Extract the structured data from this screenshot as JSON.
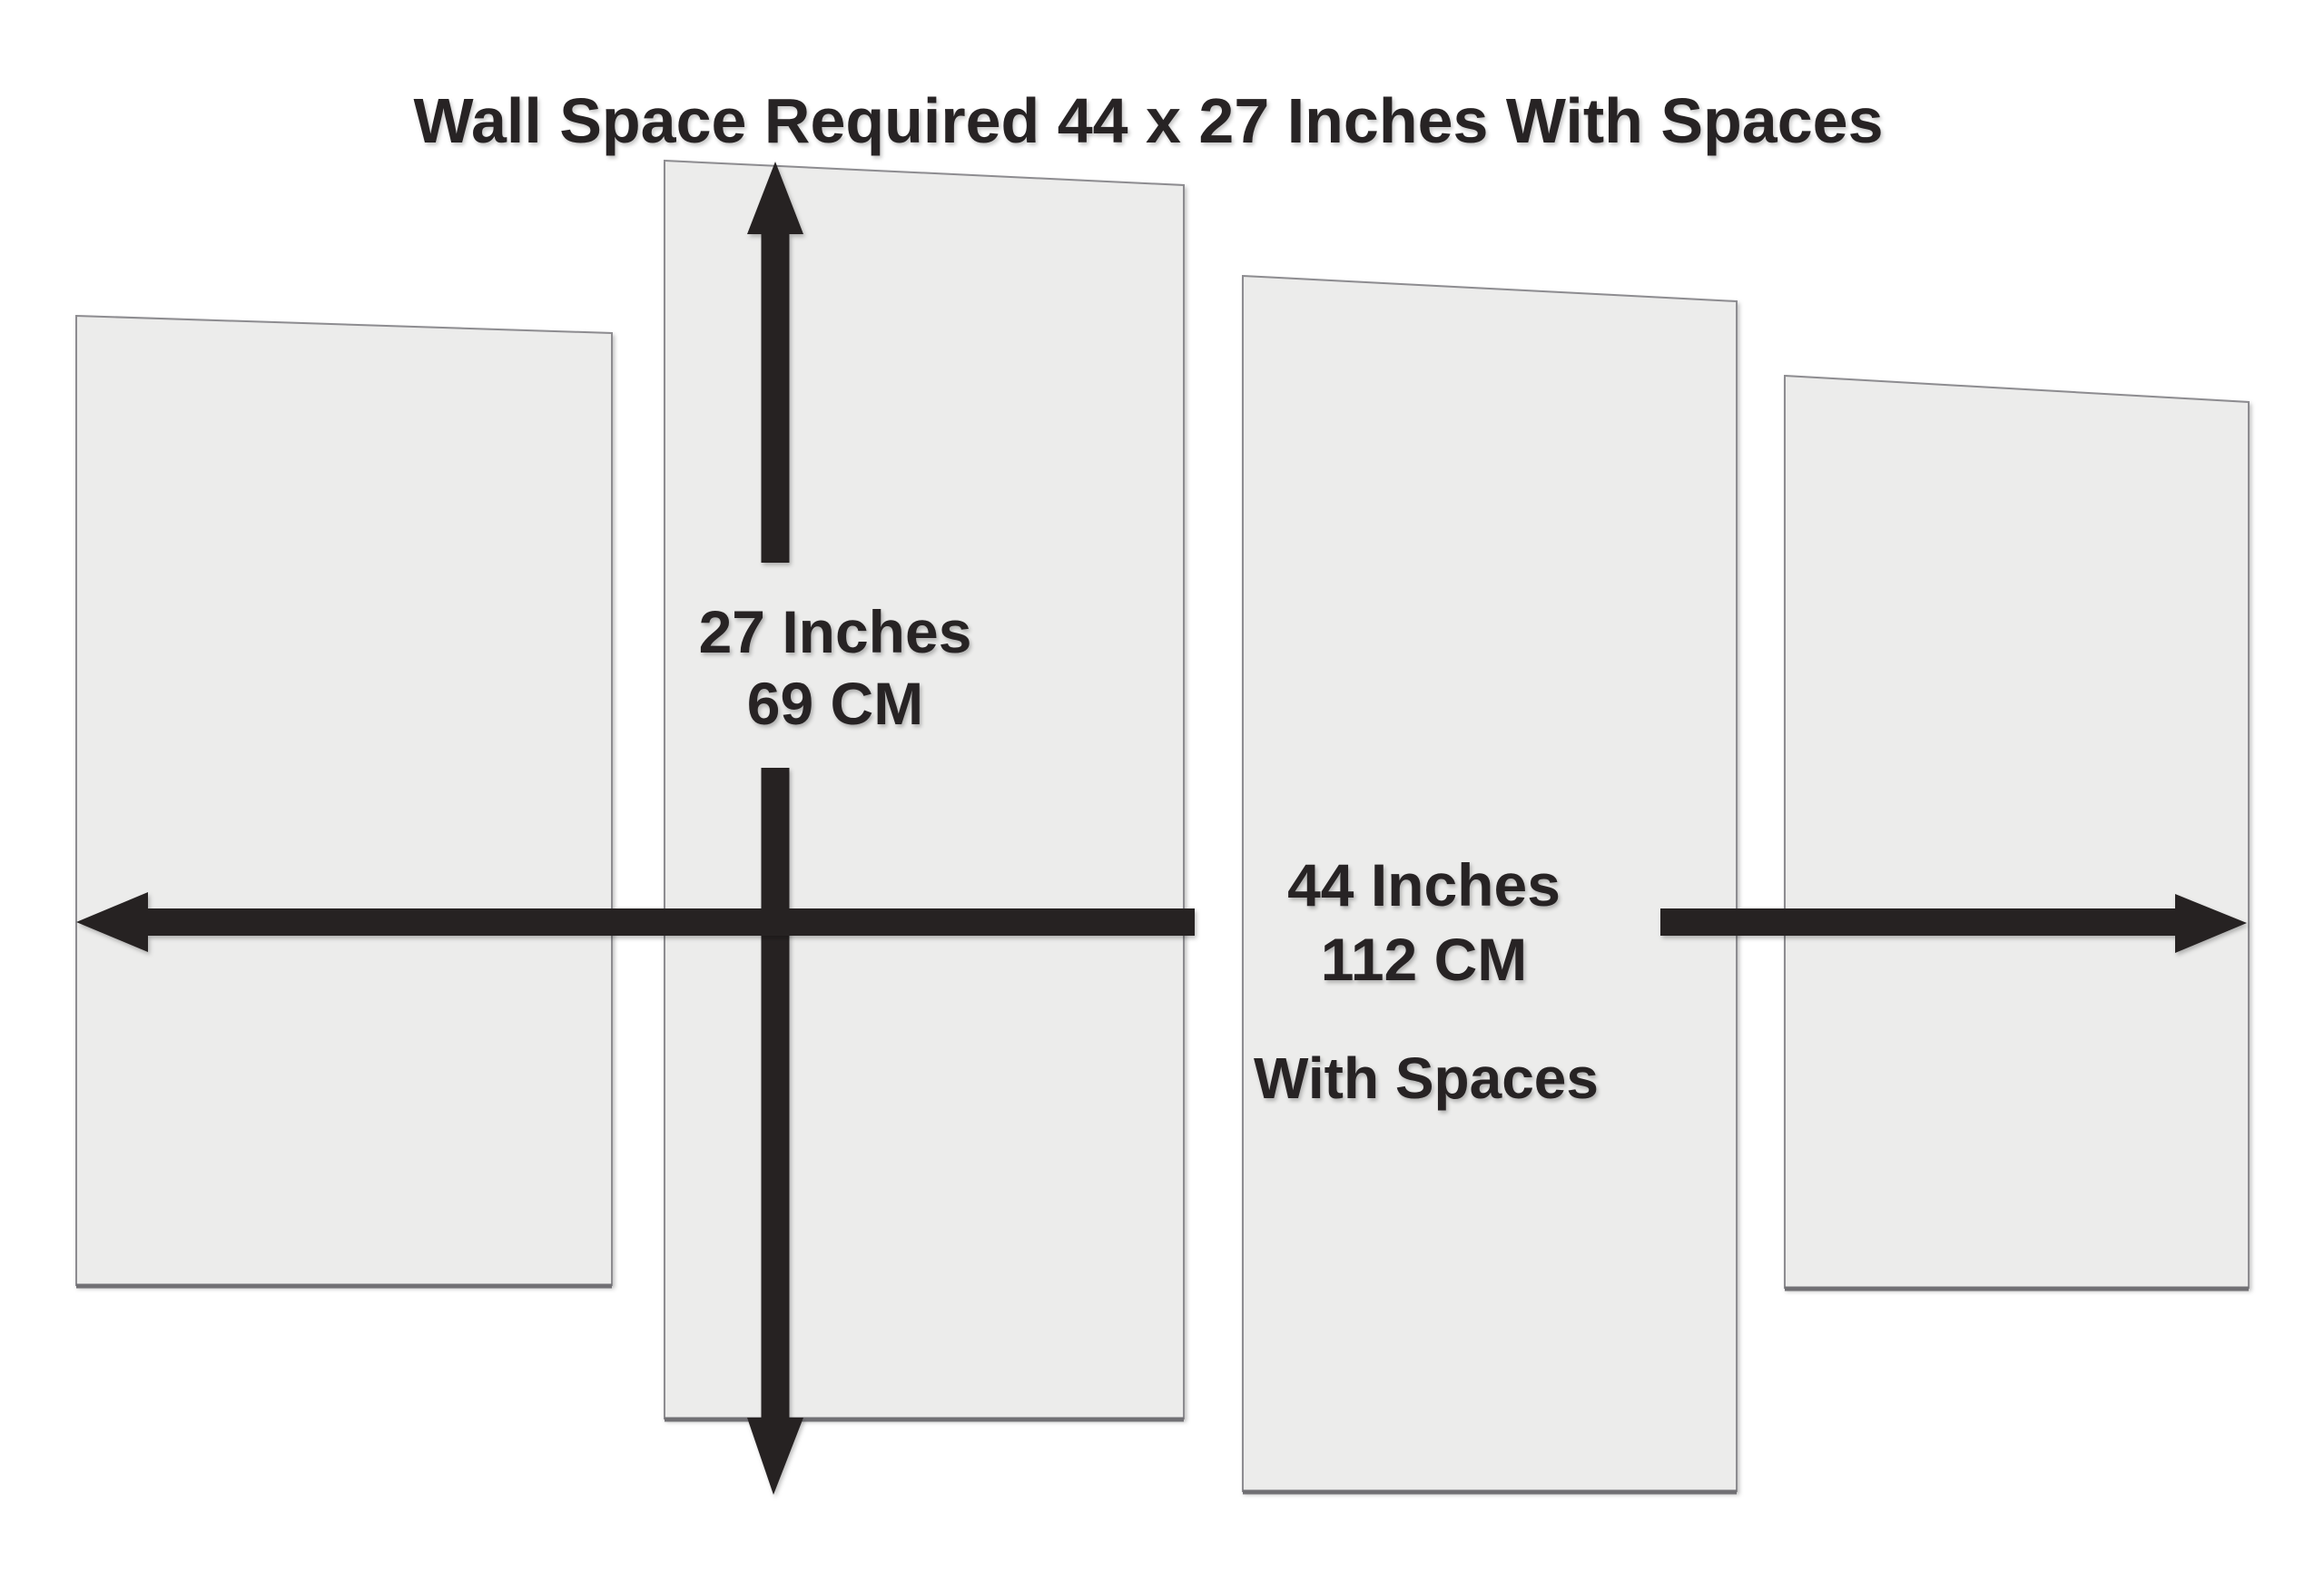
{
  "title": "Wall Space Required 44 x 27 Inches With Spaces",
  "vertical_dimension": {
    "inches": "27 Inches",
    "cm": "69 CM"
  },
  "horizontal_dimension": {
    "inches": "44 Inches",
    "cm": "112 CM",
    "note": "With Spaces"
  },
  "panels": {
    "count": 4
  },
  "theme": {
    "bg": "#ffffff",
    "panelFill": "#ececeb",
    "panelEdge": "#8d8c90",
    "panelEdgeBottom": "#717074",
    "ink": "#272324"
  }
}
